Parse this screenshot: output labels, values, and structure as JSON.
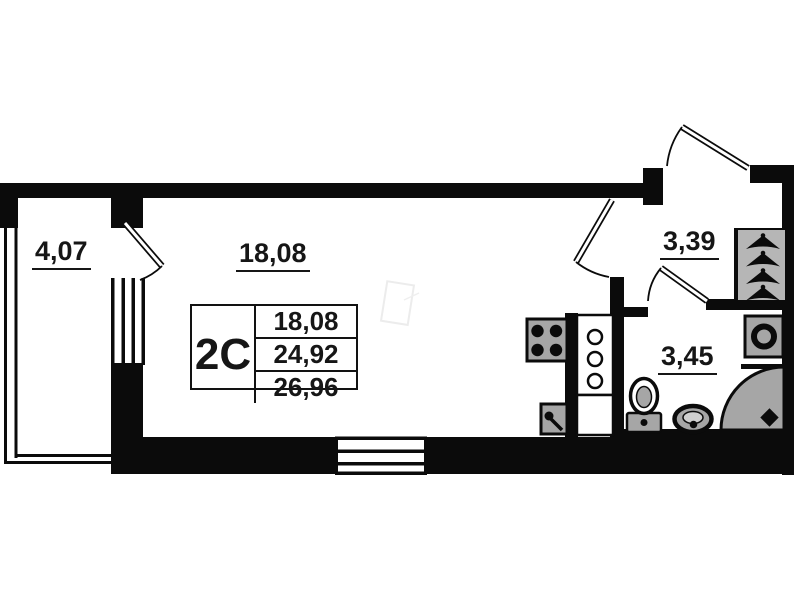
{
  "plan": {
    "rooms": [
      {
        "id": "balcony",
        "area_label": "4,07"
      },
      {
        "id": "living-room",
        "area_label": "18,08"
      },
      {
        "id": "hallway",
        "area_label": "3,39"
      },
      {
        "id": "bathroom",
        "area_label": "3,45"
      }
    ],
    "info_table": {
      "unit_type": "2С",
      "living_area": "18,08",
      "apartment_area": "24,92",
      "total_area": "26,96"
    },
    "fixtures": [
      "stove",
      "kitchen-sink",
      "ventilation-shaft",
      "toilet",
      "washbasin",
      "corner-shower",
      "washing-machine",
      "wardrobe-hangers",
      "balcony-window",
      "room-window",
      "entrance-door",
      "interior-doors"
    ],
    "colors": {
      "wall": "#0b0b0b",
      "fixture_gray": "#a6a6a6",
      "wardrobe_gray": "#b6b6b6",
      "paper": "#ffffff",
      "watermark": "#ececec"
    }
  }
}
